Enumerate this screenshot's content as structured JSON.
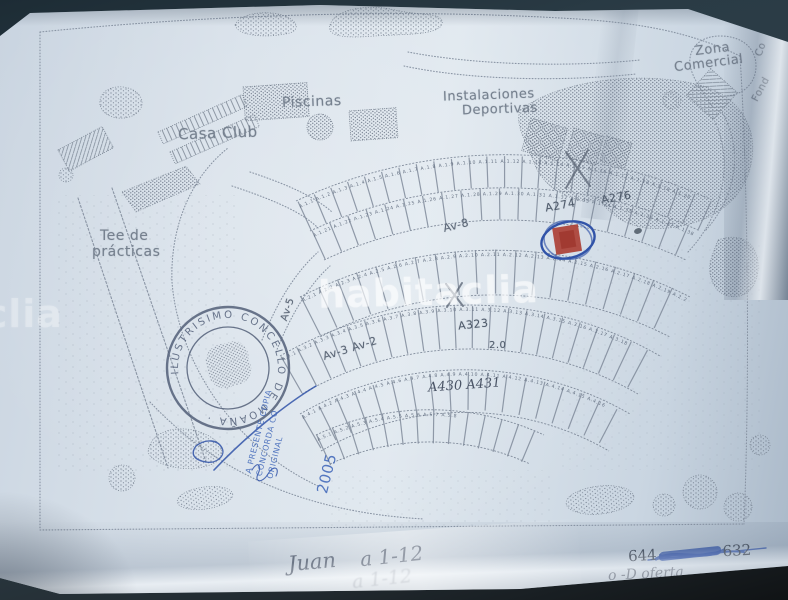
{
  "watermark": {
    "text": "habitaclia"
  },
  "map_labels": {
    "zona_comercial_1": "Zona",
    "zona_comercial_2": "Comercial",
    "instalaciones_1": "Instalaciones",
    "instalaciones_2": "Deportivas",
    "piscinas": "Piscinas",
    "casa_club": "Casa Club",
    "tee_1": "Tee de",
    "tee_2": "prácticas",
    "edge_fragment_top": "Co",
    "edge_fragment_bottom": "Fond"
  },
  "street_labels": {
    "av8": "Av-8",
    "av32": "Av-3  Av-2",
    "av5": "Av-5"
  },
  "plot_row_labels": {
    "a274": "A274",
    "a276": "A276",
    "a323": "A323",
    "n20": "2.0",
    "a430_431": "A430  A431"
  },
  "plot_numbers": {
    "band1_row1": "A.1.1  A.1.2  A.1.3  A.1.4  A.1.5  A.1.6  A.1.7  A.1.8  A.1.9  A.1.10  A.1.11  A.1.12  A.1.13  A.1.14  A.1.15  A.1.16  A.1.17  A.1.18  A.1.19  A.1.20",
    "band1_row2": "A.1.21  A.1.22  A.1.23  A.1.24  A.1.25  A.1.26  A.1.27  A.1.28  A.1.29  A.1.30  A.1.31  A.1.32  A.1.33  A.1.34  A.1.35  A.1.36  A.1.37  A.1.38",
    "band2": "A.2.1  A.2.2  A.2.3  A.2.4  A.2.5  A.2.6  A.2.7  A.2.8  A.2.9  A.2.10  A.2.11  A.2.12  A.2.13  A.2.14  A.2.15  A.2.16  A.2.17  A.2.18  A.2.19  A.2.20",
    "band3": "A.3.1  A.3.2  A.3.3  A.3.4  A.3.5  A.3.6  A.3.7  A.3.8  A.3.9  A.3.10  A.3.11  A.3.12  A.3.13  A.3.14  A.3.15  A.3.16  A.3.17  A.3.18",
    "band4": "A.4.1  A.4.2  A.4.3  A.4.4  A.4.5  A.4.6  A.4.7  A.4.8  A.4.9  A.4.10  A.4.11  A.4.12  A.4.13  A.4.14  A.4.15  A.4.16",
    "band5": "A.5.1  A.5.2  A.5.3  A.5.4  A.5.5  A.5.6  A.5.7  A.5.8"
  },
  "stamp": {
    "text": "ILUSTRISIMO CONCELLO DE MOAÑA ·",
    "color": "#4d5a74"
  },
  "certification": {
    "line1": "A PRESENTE COPIA",
    "line2": "CONCORDA CO",
    "line3": "ORIGINAL",
    "year": "2005",
    "color": "#3c64b8"
  },
  "handwriting": {
    "name": "Juan",
    "plots_range": "a 1-12",
    "phone_prefix": "644",
    "phone_suffix": "632",
    "offer_note": "o -D oferta"
  },
  "colors": {
    "ink": "#7d8898",
    "pencil": "#4a5466",
    "blue_pen": "#2b4ea6",
    "red_marker": "#a83226",
    "paper": "#d6e0ea",
    "background": "#263741"
  }
}
